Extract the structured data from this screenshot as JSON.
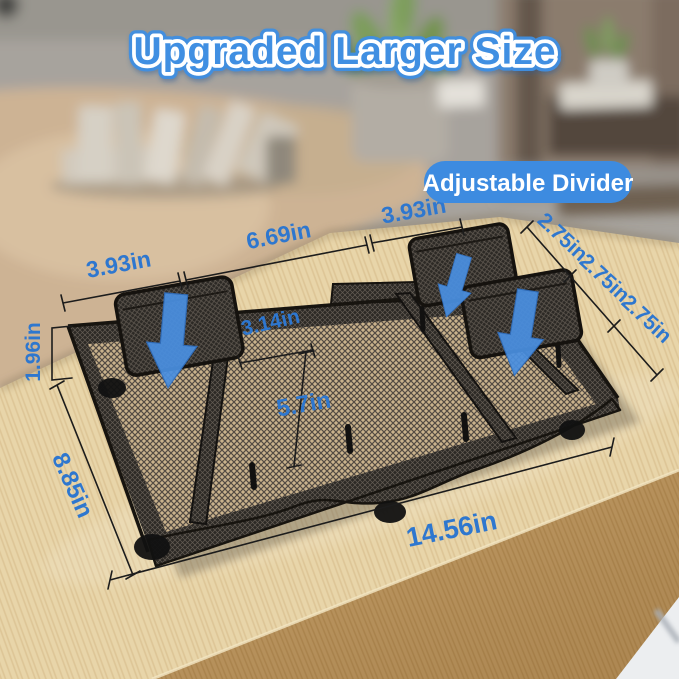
{
  "title": {
    "text": "Upgraded Larger Size"
  },
  "badge": {
    "label": "Adjustable Divider"
  },
  "dims": {
    "w_left": "3.93in",
    "w_mid": "6.69in",
    "w_right": "3.93in",
    "slot1": "2.75in",
    "slot2": "2.75in",
    "slot3": "2.75in",
    "height": "1.96in",
    "inner_w": "3.14in",
    "inner_d": "5.7in",
    "depth": "8.85in",
    "length": "14.56in"
  },
  "arrows": {
    "direction": "down",
    "count": 3
  },
  "colors": {
    "title_blue": "#3f8fe2",
    "badge_blue": "#3d8be0",
    "label_blue": "#2e77cf",
    "arrow_blue": "#4a90e2",
    "mesh_dark": "#2c2925",
    "desk_wood": "#e8d5a9"
  }
}
